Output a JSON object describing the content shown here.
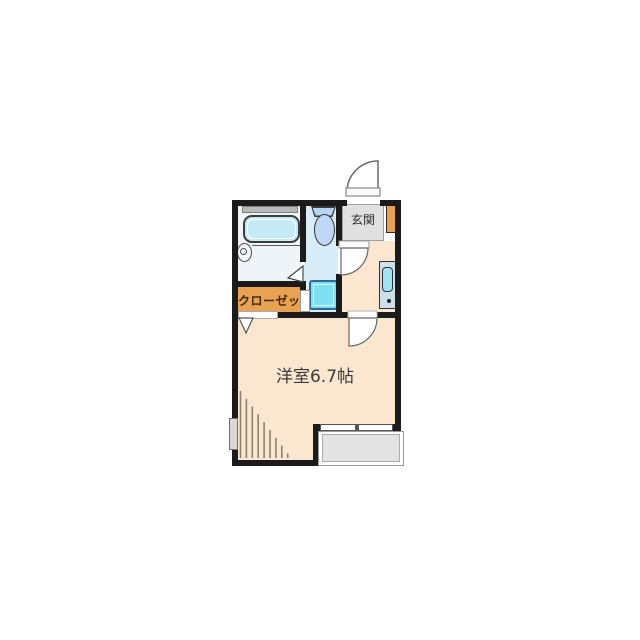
{
  "meta": {
    "type": "floor-plan",
    "description": "Japanese one-room apartment floor plan"
  },
  "labels": {
    "main_room": "洋室6.7帖",
    "entrance": "玄関",
    "closet": "クローゼット"
  },
  "rooms": [
    {
      "name": "western-room",
      "label": "洋室6.7帖",
      "color": "#fbe7cf"
    },
    {
      "name": "entrance-genkan",
      "label": "玄関",
      "color": "#e0e0e0"
    },
    {
      "name": "closet",
      "label": "クローゼット",
      "color": "#e9a251"
    },
    {
      "name": "bathroom",
      "label": "",
      "color": "#eef4f7"
    },
    {
      "name": "toilet-laundry-room",
      "label": "",
      "color": "#d9edf8"
    },
    {
      "name": "hallway",
      "label": "",
      "color": "#fbe7cf"
    }
  ],
  "fixtures": [
    "bathtub",
    "washstand",
    "bathroom-window",
    "toilet",
    "washing-machine-pan",
    "kitchenette",
    "kitchenette-sink",
    "shoe-cabinet",
    "balcony",
    "balcony-sliding-window",
    "left-wall-window",
    "entrance-door-swing",
    "washroom-door-swing",
    "main-room-door-swing",
    "closet-folding-door",
    "bathroom-folding-door",
    "sloped-ceiling-hatch"
  ],
  "colors": {
    "wall": "#1b1b1b",
    "room_peach": "#fbe7cf",
    "wet_area_blue": "#d9edf8",
    "bathroom_blue": "#eef4f7",
    "fixture_cyan": "#7edff0",
    "bathtub_cyan": "#c5eaf4",
    "accent_orange": "#e9a251",
    "genkan_gray": "#e0e0e0",
    "balcony_gray": "#e3e3e3",
    "background": "#ffffff"
  }
}
